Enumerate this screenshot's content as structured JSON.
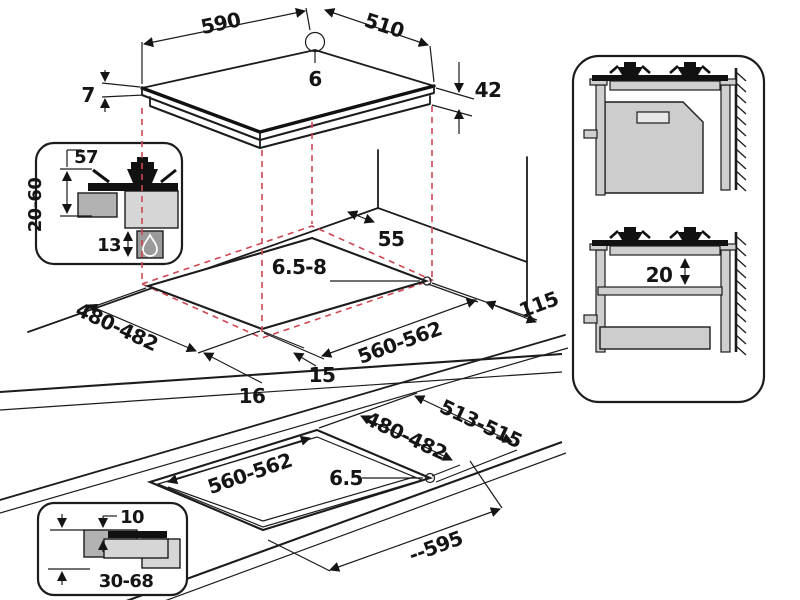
{
  "title": "Gas hob built-in installation dimensions diagram",
  "colors": {
    "line": "#1c1c1c",
    "dashed_red": "#cf4652",
    "gray_light": "#d6d6d6",
    "gray_mid": "#b2b2b2",
    "gray_dark": "#9a9a9a"
  },
  "labels": {
    "top_view": {
      "width": "590",
      "depth": "510",
      "hole_offset": "6",
      "glass_thickness": "7",
      "body_height": "42"
    },
    "burner_inset": {
      "burner_height": "57",
      "worktop_thickness": "20-60",
      "bottom_clearance": "13"
    },
    "cutout_view": {
      "rear_gap": "55",
      "hole_diameter": "6.5-8",
      "cutout_depth": "480-482",
      "cutout_width": "560-562",
      "overhang_left": "16",
      "overhang_front": "15",
      "right_gap": "115"
    },
    "flush_view": {
      "outer_width": "513-515",
      "cutout_depth": "480-482",
      "cutout_width": "560-562",
      "hole_diameter": "6.5",
      "overall_width": "--595"
    },
    "flush_inset": {
      "rebate_depth": "10",
      "worktop_thickness": "30-68"
    },
    "side_view": {
      "clearance_below_hob": "20"
    }
  },
  "icons": {
    "flame": "gas-flame-icon",
    "wall": "wall-hatching"
  }
}
